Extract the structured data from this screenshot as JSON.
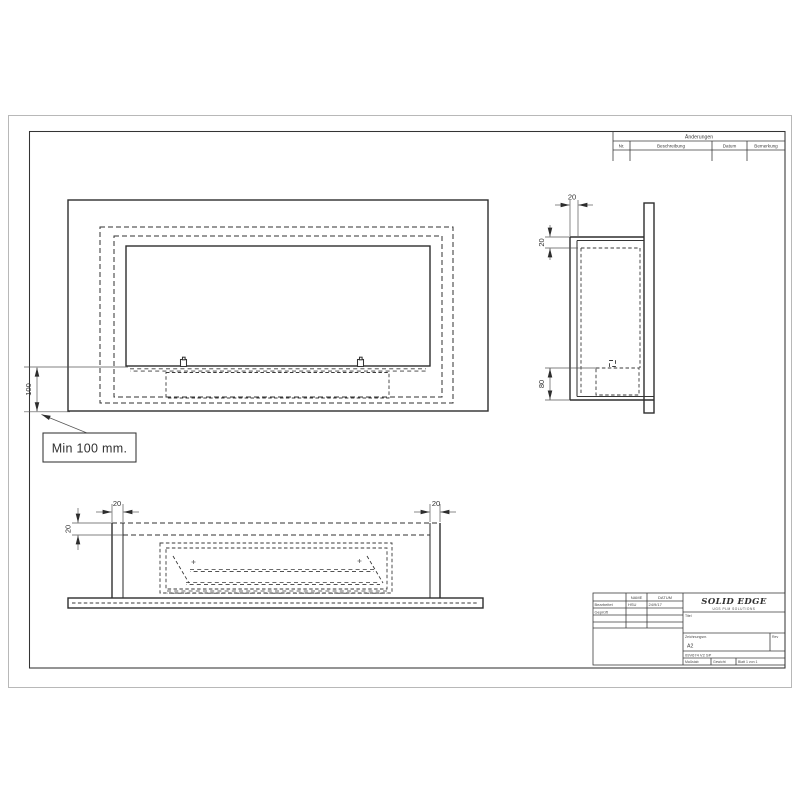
{
  "annotation": {
    "min_clearance": "Min 100 mm."
  },
  "dimensions": {
    "front_height": "100",
    "side_wall_thickness": "20",
    "side_top_offset": "20",
    "side_burner_height": "80",
    "bottom_left_thickness": "20",
    "bottom_top_offset": "20",
    "bottom_right_thickness": "20"
  },
  "revision_table": {
    "title": "Änderungen",
    "columns": [
      "Nr.",
      "Beschreibung",
      "Datum",
      "Bemerkung"
    ]
  },
  "title_block": {
    "logo": "SOLID EDGE",
    "logo_subtitle": "UGS PLM SOLUTIONS",
    "name_header": "NAME",
    "date_header": "DATUM",
    "row1_label": "Bearbeitet",
    "row1_name": "HSU",
    "row1_date": "24/9/17",
    "row2_label": "Geprüft",
    "title_label": "Titel",
    "drawing_no_label": "Zeichnungsnr.",
    "sheet_format": "A2",
    "rev_label": "Rev",
    "file_text": "09V674 V2 SP",
    "scale_label": "Maßstab",
    "weight_label": "Gewicht",
    "sheet_label": "Blatt 1 von 1"
  }
}
